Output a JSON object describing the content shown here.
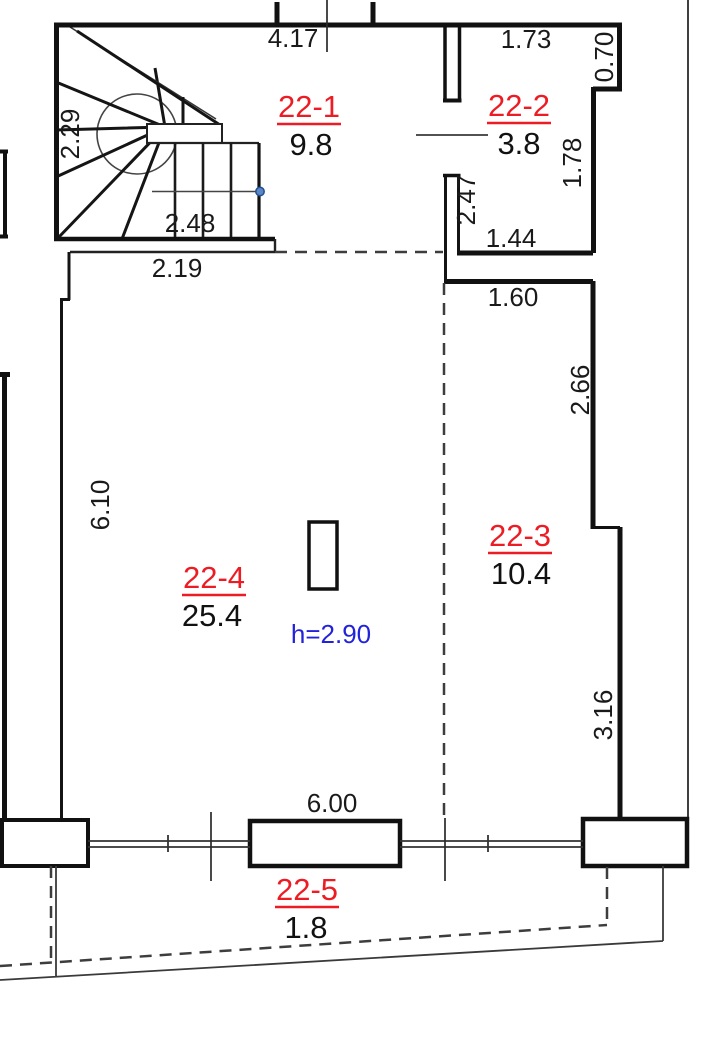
{
  "rooms": [
    {
      "label": "22-1",
      "area": "9.8"
    },
    {
      "label": "22-2",
      "area": "3.8"
    },
    {
      "label": "22-3",
      "area": "10.4"
    },
    {
      "label": "22-4",
      "area": "25.4"
    },
    {
      "label": "22-5",
      "area": "1.8"
    }
  ],
  "dimensions": {
    "top_width": "4.17",
    "r2_top": "1.73",
    "r2_notch": "0.70",
    "stair_depth": "2.29",
    "stair_width": "2.48",
    "landing_width": "2.19",
    "r2_left": "2.47",
    "r2_right": "1.78",
    "r2_bottom": "1.44",
    "r3_top": "1.60",
    "r3_right_upper": "2.66",
    "r4_left": "6.10",
    "r3_right_lower": "3.16",
    "terrace_width": "6.00"
  },
  "annotations": {
    "ceiling_height": "h=2.90"
  },
  "colors": {
    "wall": "#111111",
    "room_label": "#ed1c24",
    "dimension_text": "#1a1a1a",
    "height_note": "#2222dd",
    "stair_node": "#5b87c9",
    "dashed_line": "#3d3d3d",
    "background": "#ffffff"
  }
}
